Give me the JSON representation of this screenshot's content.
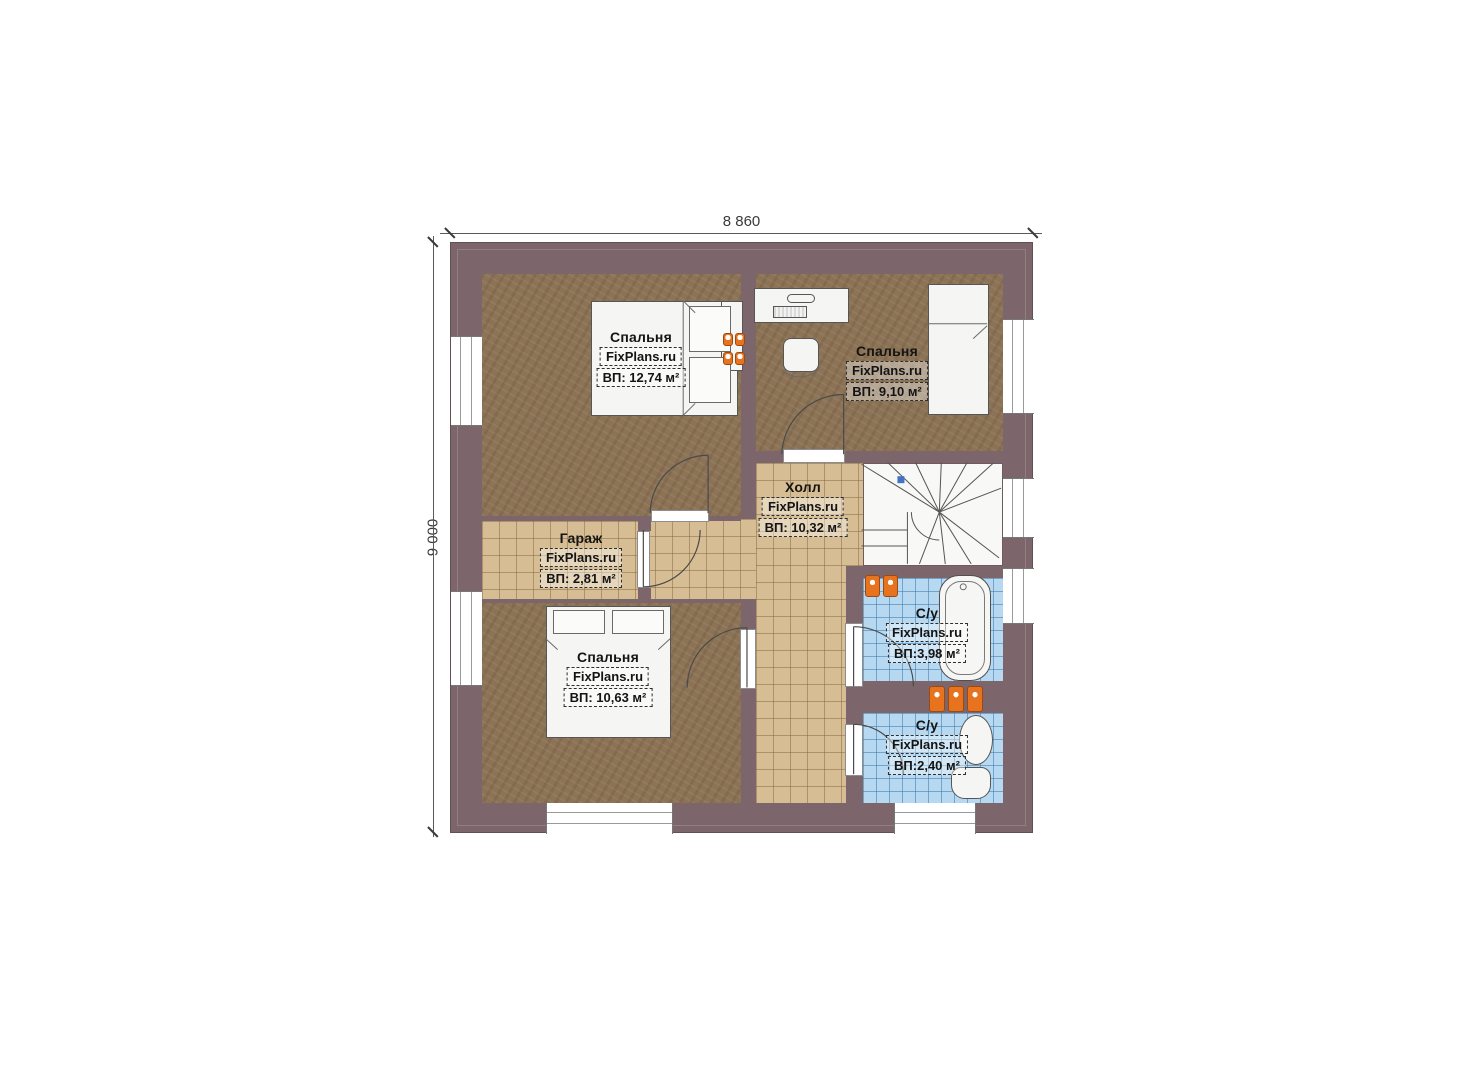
{
  "plan": {
    "title": "floor-plan",
    "dimensions": {
      "width": "8 860",
      "height": "9 000"
    },
    "brand": "FixPlans.ru",
    "rooms": [
      {
        "id": "bedroom-top-left",
        "name": "Спальня",
        "brand": "FixPlans.ru",
        "area": "ВП: 12,74 м²"
      },
      {
        "id": "bedroom-top-right",
        "name": "Спальня",
        "brand": "FixPlans.ru",
        "area": "ВП: 9,10 м²"
      },
      {
        "id": "hall",
        "name": "Холл",
        "brand": "FixPlans.ru",
        "area": "ВП: 10,32 м²"
      },
      {
        "id": "garage",
        "name": "Гараж",
        "brand": "FixPlans.ru",
        "area": "ВП: 2,81 м²"
      },
      {
        "id": "bedroom-bottom",
        "name": "Спальня",
        "brand": "FixPlans.ru",
        "area": "ВП: 10,63 м²"
      },
      {
        "id": "bathroom-1",
        "name": "С/у",
        "brand": "FixPlans.ru",
        "area": "ВП:3,98 м²"
      },
      {
        "id": "bathroom-2",
        "name": "С/у",
        "brand": "FixPlans.ru",
        "area": "ВП:2,40 м²"
      }
    ],
    "palette": {
      "wall": "#7d666b",
      "wood_floor": "#8c7355",
      "tile_floor": "#d7bd93",
      "bath_tile": "#b7d8f1",
      "radiator_orange": "#e8731f",
      "stair_marker_blue": "#4472c4",
      "dimension_text": "#3a3a3a"
    }
  }
}
